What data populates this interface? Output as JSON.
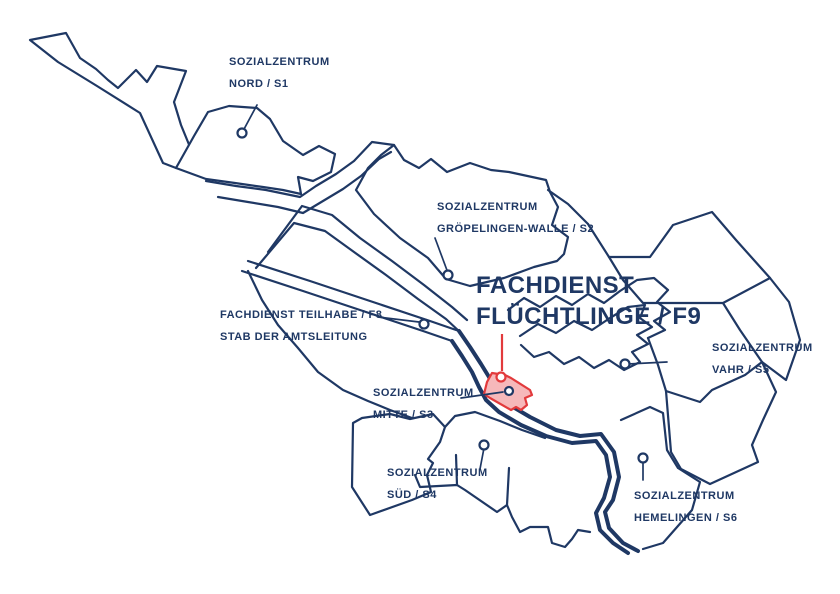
{
  "map": {
    "description": "Districts map of Bremen with social service center offices",
    "colors": {
      "outline": "#1f3864",
      "highlight_fill": "#f6b8ba",
      "highlight_stroke": "#e23a3c",
      "background": "#ffffff"
    },
    "highlighted_office": "FACHDIENST FLÜCHTLINGE / F9",
    "region_labels": [
      {
        "id": "nord-s1",
        "line1": "SOZIALZENTRUM",
        "line2": "NORD / S1"
      },
      {
        "id": "groepelingen-walle-s2",
        "line1": "SOZIALZENTRUM",
        "line2": "GRÖPELINGEN-WALLE / S2"
      },
      {
        "id": "fluechtlinge-f9",
        "line1": "FACHDIENST",
        "line2": "FLÜCHTLINGE / F9"
      },
      {
        "id": "teilhabe-f8",
        "line1": "FACHDIENST TEILHABE / F8",
        "line2": "STAB DER AMTSLEITUNG"
      },
      {
        "id": "mitte-s3",
        "line1": "SOZIALZENTRUM",
        "line2": "MITTE / S3"
      },
      {
        "id": "vahr-s5",
        "line1": "SOZIALZENTRUM",
        "line2": "VAHR / S5"
      },
      {
        "id": "sued-s4",
        "line1": "SOZIALZENTRUM",
        "line2": "SÜD / S4"
      },
      {
        "id": "hemelingen-s6",
        "line1": "SOZIALZENTRUM",
        "line2": "HEMELINGEN / S6"
      }
    ]
  }
}
